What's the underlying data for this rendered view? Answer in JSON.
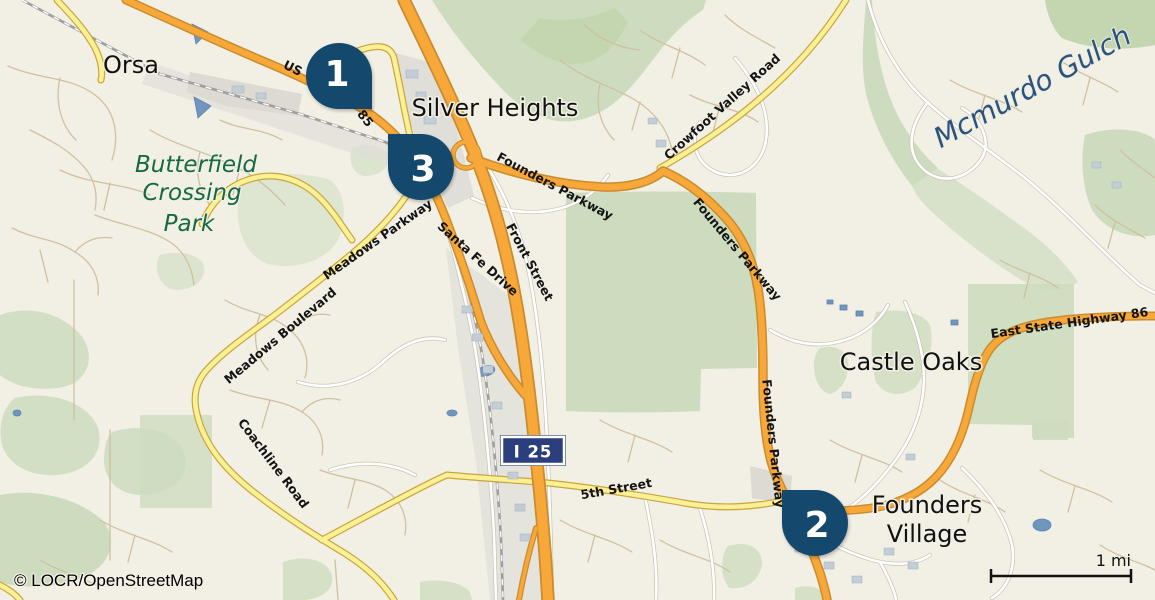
{
  "colors": {
    "background": "#f2efe5",
    "park_green": "#cddcbf",
    "urban_gray": "#e1dfd8",
    "water_blue": "#7096bf",
    "highway_orange_fill": "#f7a838",
    "highway_orange_casing": "#c98c2e",
    "secondary_yellow_fill": "#faf096",
    "secondary_yellow_casing": "#c9a53c",
    "marker_navy": "#14496d",
    "shield_navy": "#2b3e7d",
    "park_label_green": "#156a44",
    "water_label_blue": "#2b527d"
  },
  "places": {
    "orsa": "Orsa",
    "silver_heights": "Silver Heights",
    "castle_oaks": "Castle Oaks",
    "founders_village": [
      "Founders",
      "Village"
    ],
    "butterfield_park": [
      "Butterfield",
      "Crossing",
      "Park"
    ],
    "mcmurdo_gulch": "Mcmurdo Gulch"
  },
  "roads": {
    "us_route_prefix": "US",
    "us_route_number": "85",
    "founders_parkway": "Founders Parkway",
    "crowfoot_valley_road": "Crowfoot Valley Road",
    "east_state_highway_86": "East State Highway 86",
    "fifth_street": "5th Street",
    "santa_fe_drive": "Santa Fe Drive",
    "front_street": "Front Street",
    "meadows_parkway": "Meadows Parkway",
    "meadows_boulevard": "Meadows Boulevard",
    "coachline_road": "Coachline Road",
    "interstate_shield": "I 25"
  },
  "markers": [
    {
      "id": 1,
      "label": "1"
    },
    {
      "id": 2,
      "label": "2"
    },
    {
      "id": 3,
      "label": "3"
    }
  ],
  "footer": {
    "attribution": "© LOCR/OpenStreetMap",
    "scale_label": "1 mi"
  }
}
